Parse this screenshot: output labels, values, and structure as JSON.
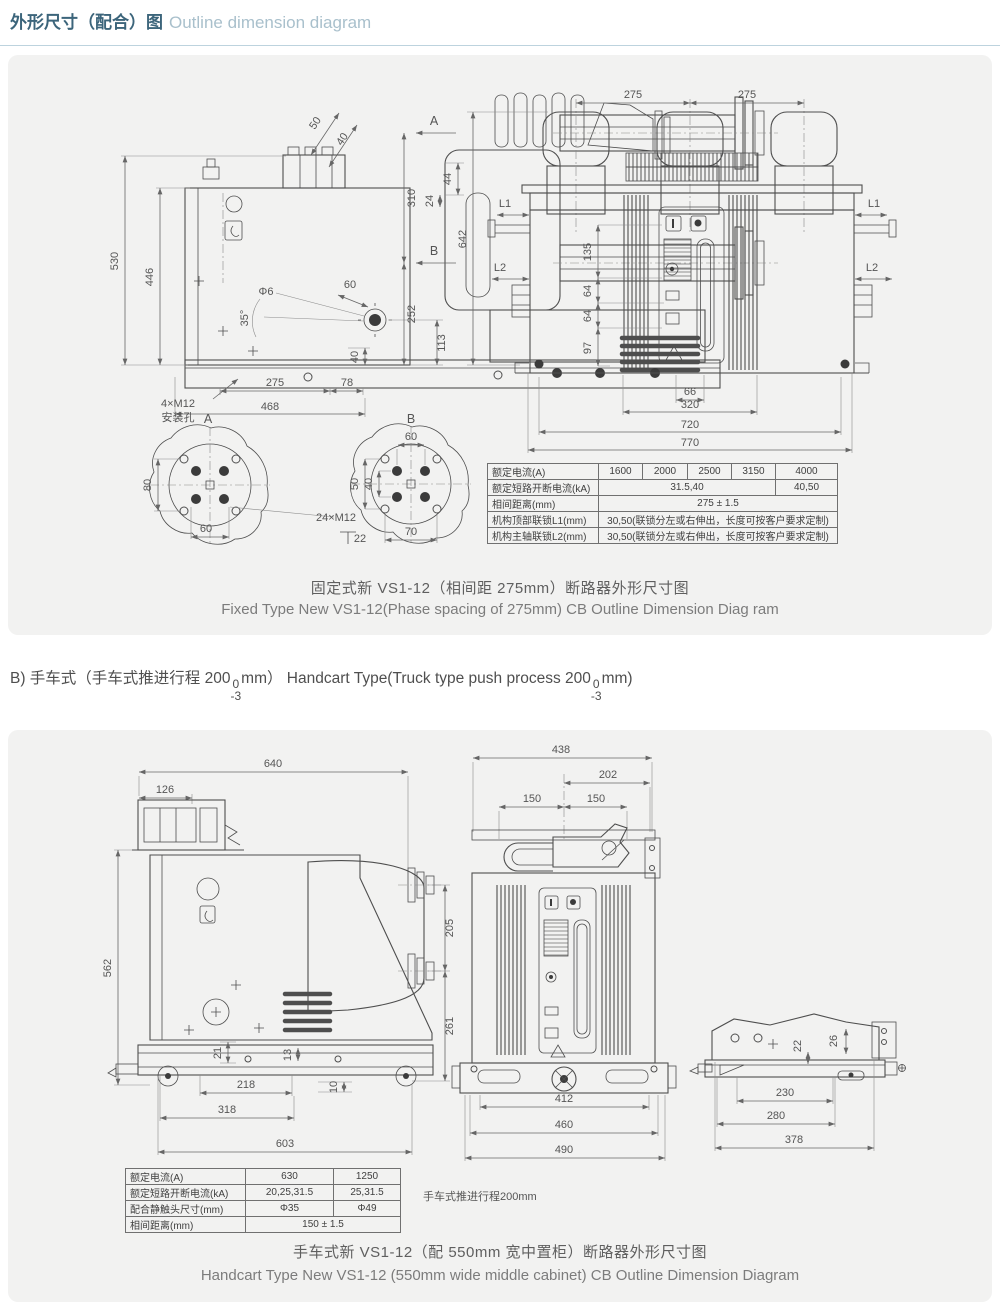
{
  "header": {
    "title_zh": "外形尺寸（配合）图",
    "title_en": "Outline dimension diagram"
  },
  "fixed": {
    "side": {
      "d530": "530",
      "d446": "446",
      "d50": "50",
      "d40a": "40",
      "d44": "44",
      "d24": "24",
      "dphi6": "Φ6",
      "d60": "60",
      "dang35": "35°",
      "d113": "113",
      "d40b": "40",
      "labelA": "A",
      "labelB": "B",
      "d310": "310",
      "d252": "252",
      "d275": "275",
      "d78": "78",
      "d468": "468",
      "mount1": "4×M12",
      "mount2": "安装孔"
    },
    "front": {
      "d275a": "275",
      "d275b": "275",
      "d642": "642",
      "l1L": "L1",
      "l1R": "L1",
      "l2L": "L2",
      "l2R": "L2",
      "d135": "135",
      "d64a": "64",
      "d64b": "64",
      "d97": "97",
      "d66": "66",
      "d320": "320",
      "d720": "720",
      "d770": "770"
    },
    "detailA": {
      "label": "A",
      "d80": "80",
      "d60": "60",
      "note": "24×M12",
      "d22": "22"
    },
    "detailB": {
      "label": "B",
      "d60": "60",
      "d50": "50",
      "d40": "40",
      "d70": "70"
    },
    "table": {
      "rows": [
        {
          "label": "额定电流(A)",
          "c1": "1600",
          "c2": "2000",
          "c3": "2500",
          "c4": "3150",
          "c5": "4000"
        },
        {
          "label": "额定短路开断电流(kA)",
          "c1": "31.5,40",
          "c2": "40,50"
        },
        {
          "label": "相间距离(mm)",
          "c1": "275 ± 1.5"
        },
        {
          "label": "机构顶部联锁L1(mm)",
          "c1": "30,50(联锁分左或右伸出，长度可按客户要求定制)"
        },
        {
          "label": "机构主轴联锁L2(mm)",
          "c1": "30,50(联锁分左或右伸出，长度可按客户要求定制)"
        }
      ]
    },
    "caption_zh": "固定式新 VS1-12（相间距 275mm）断路器外形尺寸图",
    "caption_en": "Fixed Type New VS1-12(Phase spacing  of 275mm) CB Outline Dimension  Diag ram"
  },
  "section_b": {
    "prefix": "B) 手车式（手车式推进行程 200",
    "tol_top": "0",
    "tol_bottom": "-3",
    "mid": "mm）  Handcart Type(Truck type push process 200",
    "suffix": "mm)"
  },
  "handcart": {
    "side": {
      "d640": "640",
      "d126": "126",
      "d562": "562",
      "d205": "205",
      "d261": "261",
      "d21": "21",
      "d13": "13",
      "d10": "10",
      "d218": "218",
      "d318": "318",
      "d603": "603"
    },
    "front": {
      "d438": "438",
      "d202": "202",
      "d150a": "150",
      "d150b": "150",
      "d412": "412",
      "d460": "460",
      "d490": "490"
    },
    "base": {
      "d22": "22",
      "d26": "26",
      "d230": "230",
      "d280": "280",
      "d378": "378"
    },
    "table": {
      "rows": [
        {
          "label": "额定电流(A)",
          "c1": "630",
          "c2": "1250"
        },
        {
          "label": "额定短路开断电流(kA)",
          "c1": "20,25,31.5",
          "c2": "25,31.5"
        },
        {
          "label": "配合静触头尺寸(mm)",
          "c1": "Φ35",
          "c2": "Φ49"
        },
        {
          "label": "相间距离(mm)",
          "c1": "150 ± 1.5"
        }
      ]
    },
    "note": "手车式推进行程200mm",
    "caption_zh": "手车式新 VS1-12（配 550mm 宽中置柜）断路器外形尺寸图",
    "caption_en": "Handcart Type New VS1-12 (550mm wide  middle cabinet) CB Outline Dimension Diagram"
  }
}
